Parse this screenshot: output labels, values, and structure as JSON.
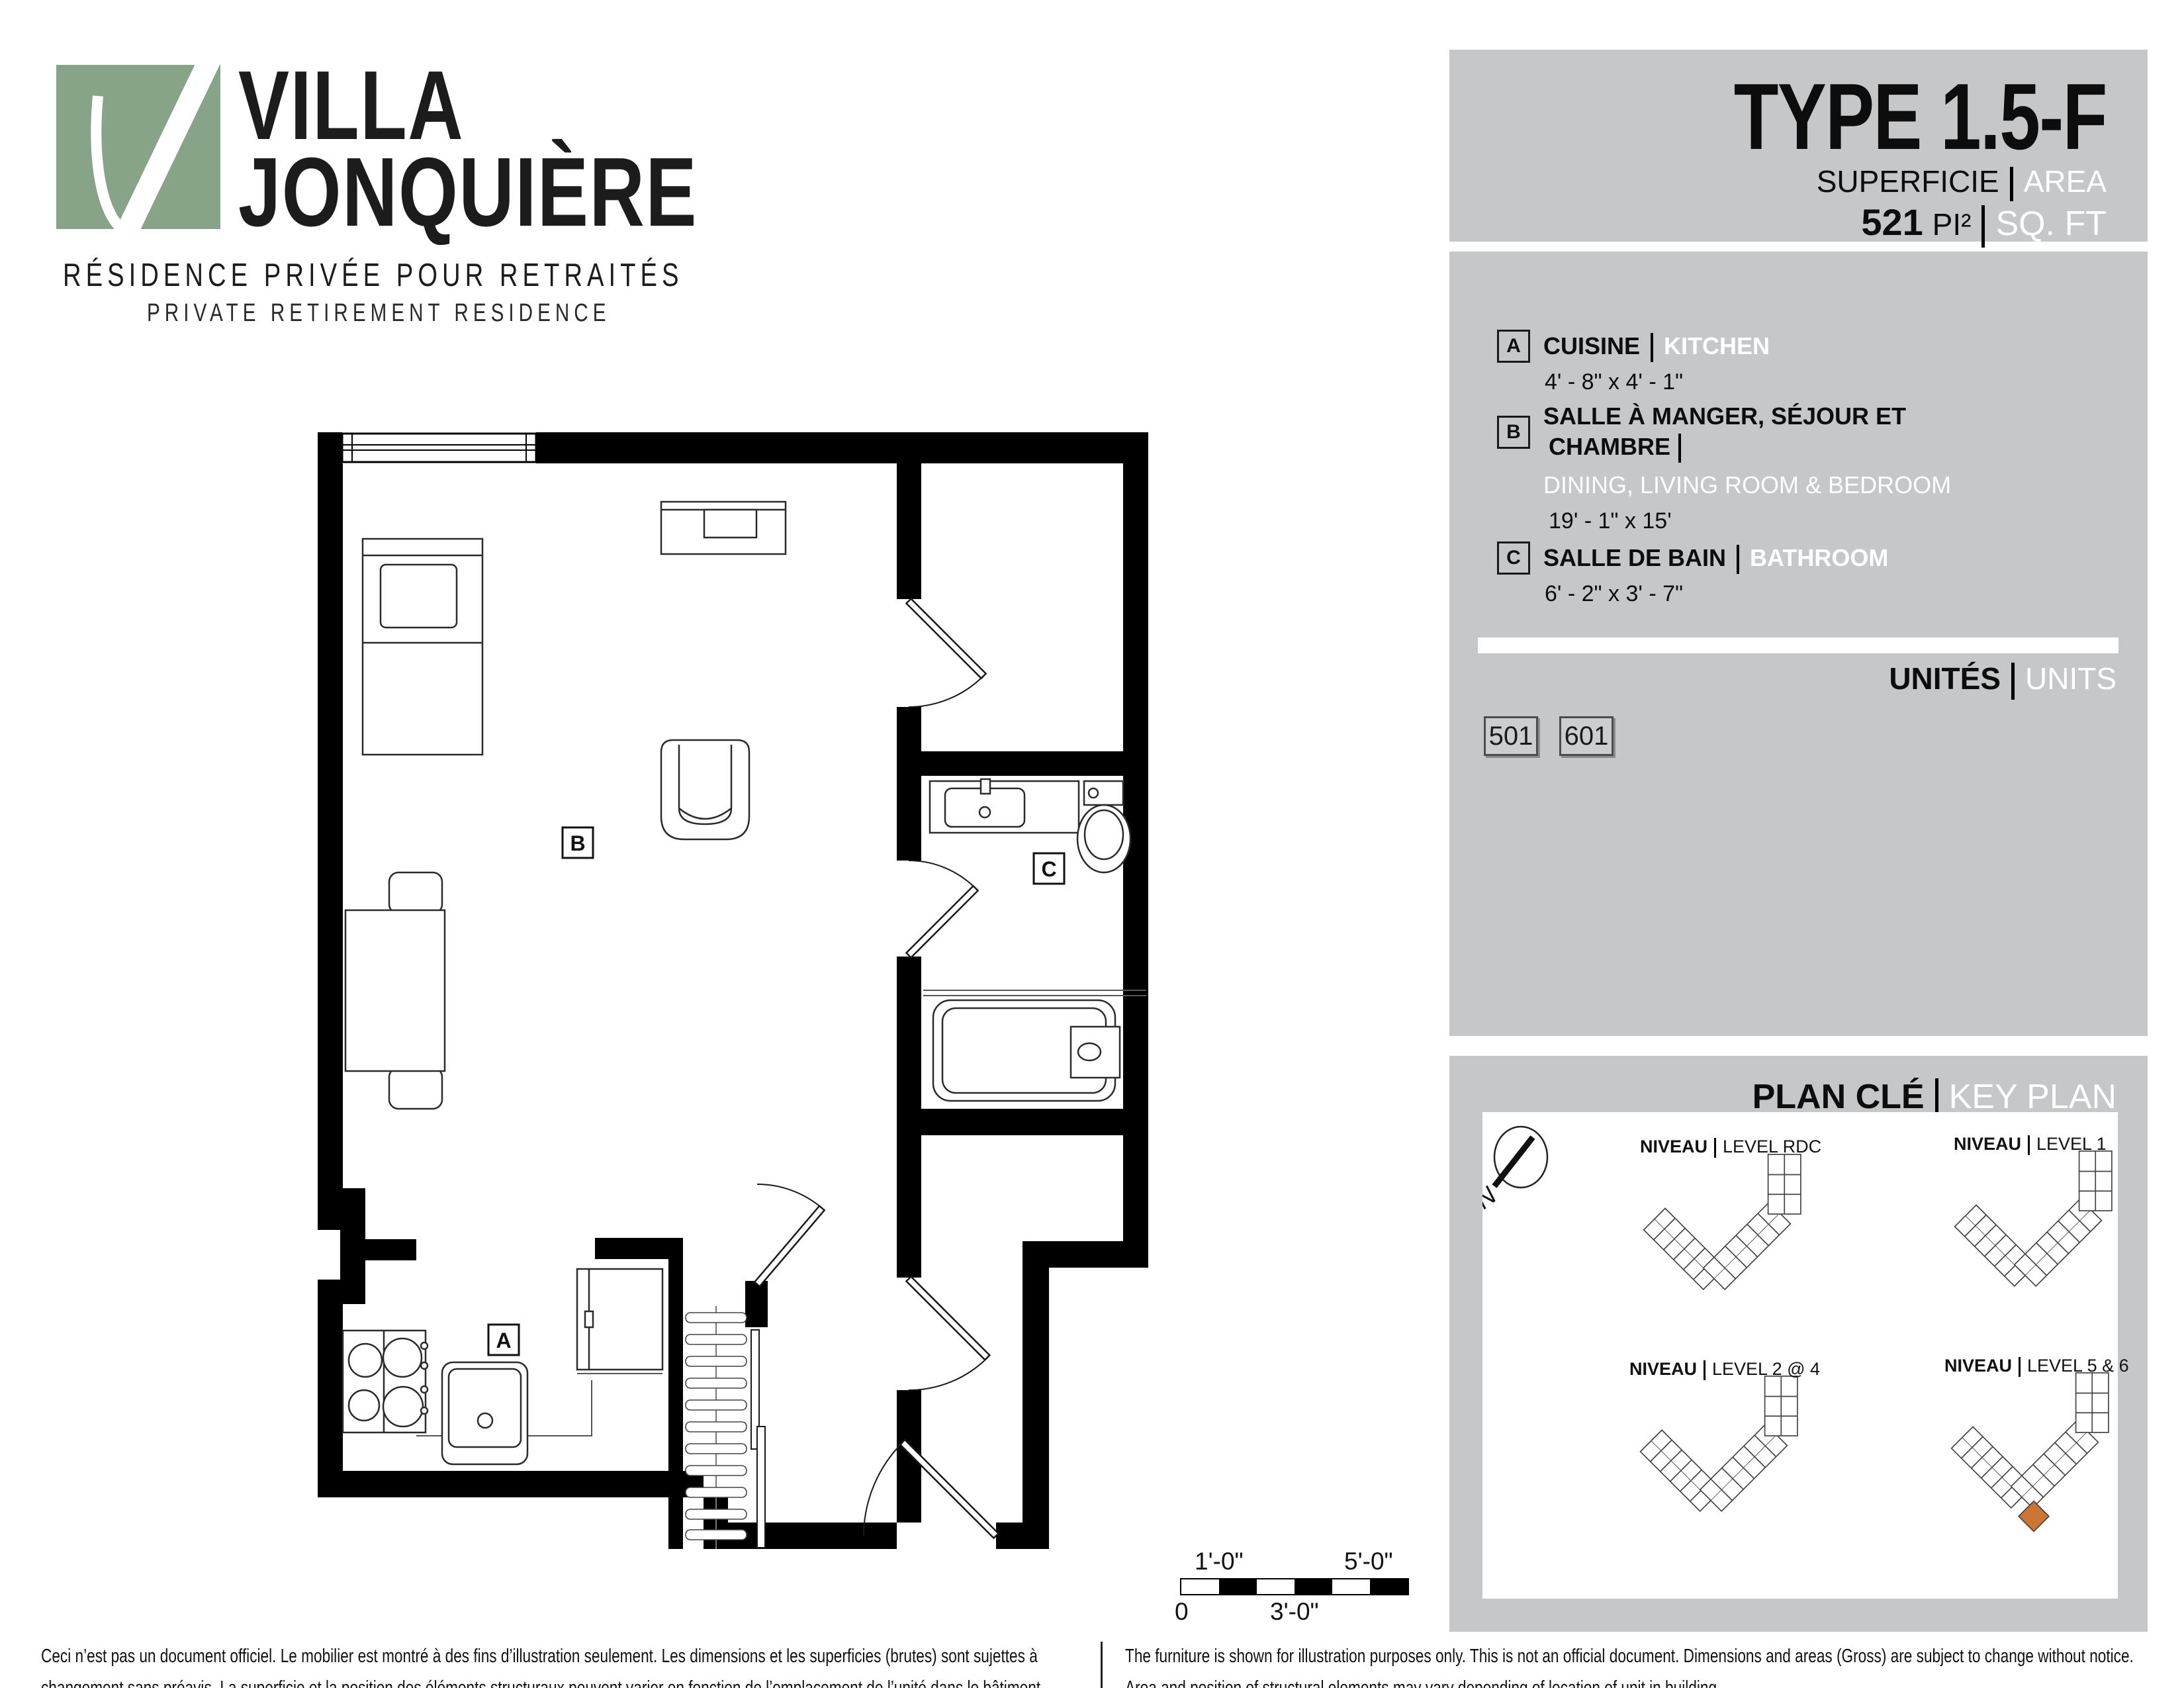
{
  "logo": {
    "name_line1": "VILLA",
    "name_line2": "JONQUIÈRE",
    "tagline_fr": "RÉSIDENCE PRIVÉE POUR RETRAITÉS",
    "tagline_en": "PRIVATE RETIREMENT RESIDENCE"
  },
  "title_block": {
    "type_title": "TYPE  1.5-F",
    "area_label_fr": "SUPERFICIE",
    "area_label_en": "AREA",
    "area_value": "521",
    "area_unit_fr": "PI²",
    "area_unit_en": "SQ. FT"
  },
  "legend": {
    "items": [
      {
        "key": "A",
        "name_fr": "CUISINE",
        "name_en": "KITCHEN",
        "dims": "4' - 8\" x 4' - 1\""
      },
      {
        "key": "B",
        "name_fr_line1": "SALLE À MANGER, SÉJOUR ET",
        "name_fr_line2": "CHAMBRE",
        "name_en": "DINING, LIVING ROOM & BEDROOM",
        "dims": "19' - 1\" x 15'"
      },
      {
        "key": "C",
        "name_fr": "SALLE DE BAIN",
        "name_en": "BATHROOM",
        "dims": "6' - 2\" x 3' - 7\""
      }
    ]
  },
  "units": {
    "label_fr": "UNITÉS",
    "label_en": "UNITS",
    "numbers": [
      "501",
      "601"
    ]
  },
  "key_plan": {
    "label_fr": "PLAN CLÉ",
    "label_en": "KEY PLAN",
    "north_label": "N",
    "levels": [
      {
        "label_fr": "NIVEAU",
        "label_en": "LEVEL RDC"
      },
      {
        "label_fr": "NIVEAU",
        "label_en": "LEVEL 1"
      },
      {
        "label_fr": "NIVEAU",
        "label_en": "LEVEL 2 @ 4"
      },
      {
        "label_fr": "NIVEAU",
        "label_en": "LEVEL 5 & 6"
      }
    ],
    "highlight_color": "#cc7433"
  },
  "plan": {
    "room_labels": [
      "A",
      "B",
      "C"
    ]
  },
  "scale_bar": {
    "top_left": "1'-0\"",
    "top_right": "5'-0\"",
    "bottom_left": "0",
    "bottom_center": "3'-0\""
  },
  "footer": {
    "fr_line1": "Ceci n’est pas un document officiel.  Le mobilier est montré à des fins d’illustration seulement.  Les dimensions et les superficies (brutes) sont sujettes à",
    "fr_line2": "changement sans préavis. La superficie et la position des éléments structuraux peuvent varier en fonction de l’emplacement de l’unité dans le bâtiment.",
    "en_line1": "The furniture is shown for illustration purposes only.  This is not an official document.  Dimensions and areas (Gross) are subject to change without notice.",
    "en_line2": "Area and position of structural elements may vary depending of location of unit in building."
  },
  "colors": {
    "brand_green": "#87a489",
    "panel_gray": "#c6c7c9",
    "highlight_orange": "#cc7433"
  }
}
